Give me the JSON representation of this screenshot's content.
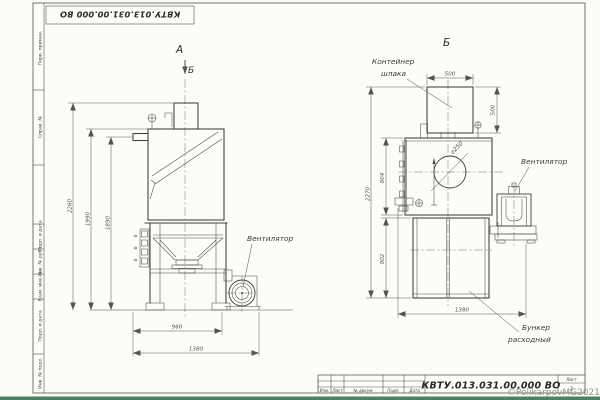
{
  "frame": {
    "doc_number_top": "КВТУ.013.031.00.000  ВО",
    "margin_cells": [
      "Перв. примен.",
      "Справ. №",
      "Подп. и дата",
      "Инв. № дубл.",
      "Взам. инв. №",
      "Подп. и дата",
      "Инв. № подл."
    ]
  },
  "title_block": {
    "doc_number": "КВТУ.013.031.00.000  ВО",
    "columns": {
      "izm": "Изм.",
      "list": "Лист",
      "doc": "№ докум.",
      "podp": "Подп.",
      "date": "Дата"
    },
    "sheet_label": "Лист",
    "sheet_number": "2"
  },
  "watermark": "©PolikarpovMG2021",
  "view_a": {
    "title": "А",
    "section_mark": "Б",
    "fan_label": "Вентилятор",
    "dims": {
      "height_total": "2260",
      "height_body": "1990",
      "height_inlet": "1890",
      "width_stand": "960",
      "width_total": "1380"
    }
  },
  "view_b": {
    "title": "Б",
    "slag_container_line1": "Контейнер",
    "slag_container_line2": "шлака",
    "fan_label": "Вентилятор",
    "hopper_line1": "Бункер",
    "hopper_line2": "расходный",
    "dims": {
      "container_width": "500",
      "container_height": "500",
      "height_total": "2270",
      "body_height": "804",
      "hopper_height": "902",
      "depth_total": "1380",
      "inlet_hole": "⌀250"
    }
  }
}
